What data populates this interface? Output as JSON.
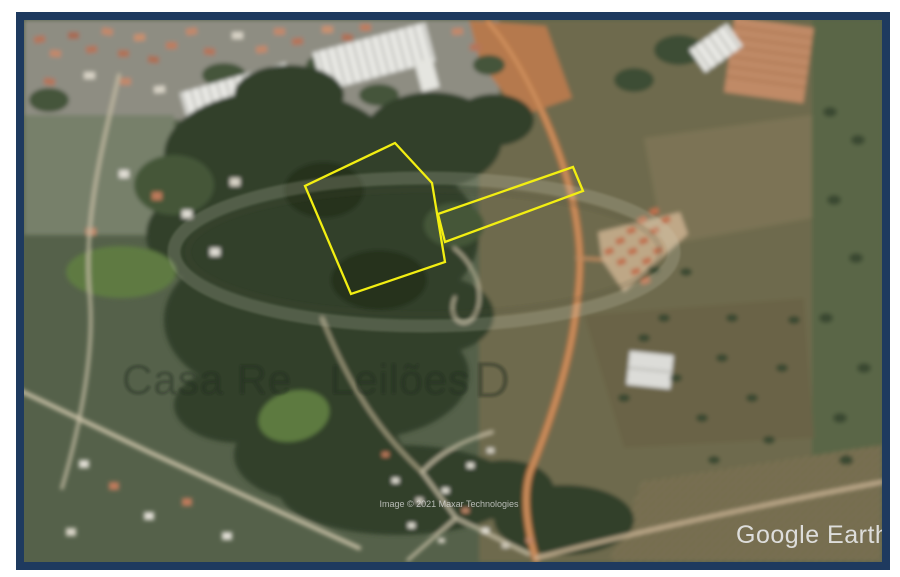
{
  "window": {
    "width_px": 900,
    "height_px": 577
  },
  "frame": {
    "border_color": "#1e3a5f",
    "page_background": "#ffffff"
  },
  "map": {
    "kind": "satellite-imagery",
    "branding": {
      "logo_text": "Google Earth"
    },
    "attribution": {
      "text": "Image © 2021 Maxar Technologies"
    },
    "watermark": {
      "part1": "Casa Re",
      "part2": "Leilões",
      "part3": "D"
    },
    "overlays": {
      "parcel_stroke_color": "#f2ee12",
      "parcel1_points": "371,123 408,163 421,242 327,274 281,166",
      "parcel2_points": "414,194 549,147 559,171 421,222"
    }
  }
}
